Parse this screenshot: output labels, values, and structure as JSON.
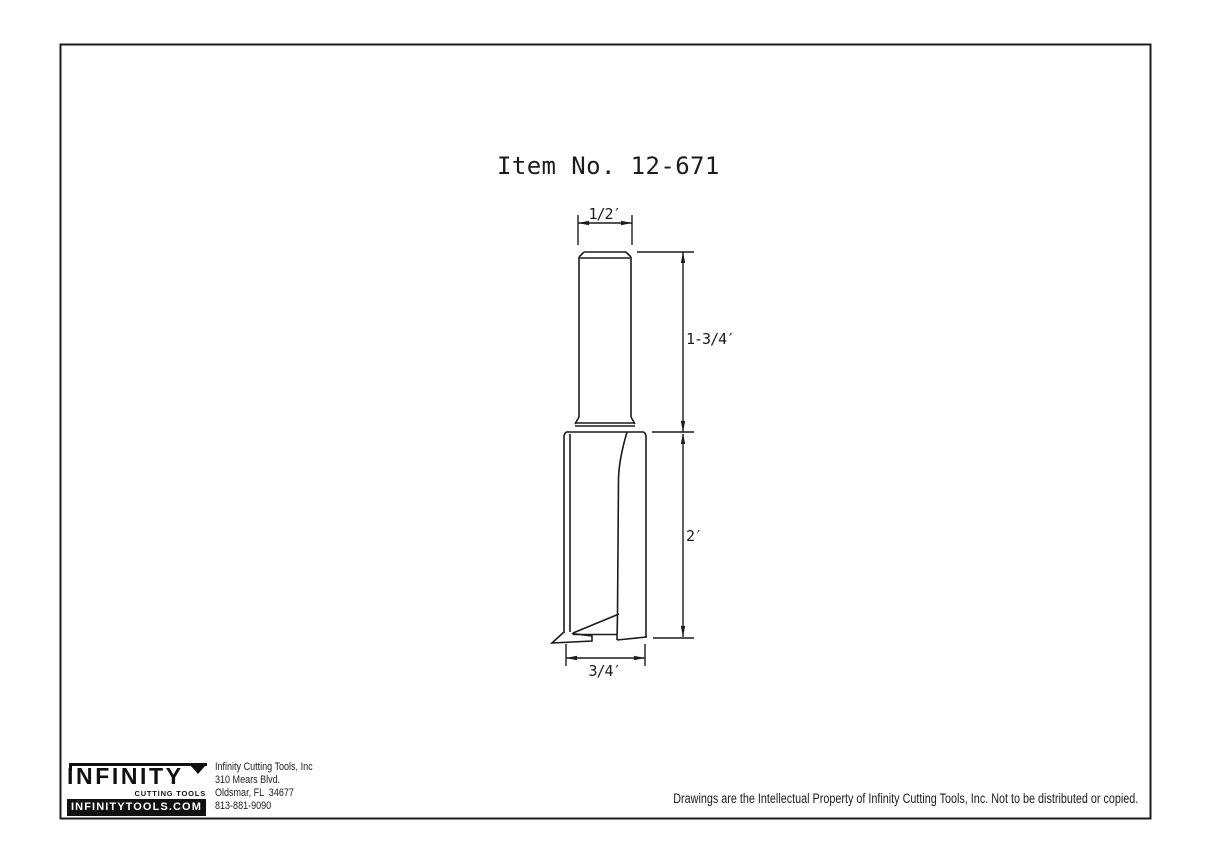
{
  "drawing": {
    "item_label": "Item No. 12-671",
    "dimensions": {
      "shank_diameter": "1/2′",
      "shank_length": "1-3/4′",
      "cutting_length": "2′",
      "cutting_diameter": "3/4′"
    }
  },
  "footer": {
    "logo": {
      "brand": "INFINITY",
      "tagline": "CUTTING TOOLS",
      "website": "INFINITYTOOLS.COM"
    },
    "address": {
      "company": "Infinity Cutting Tools, Inc",
      "street": "310 Mears Blvd.",
      "city_state_zip": "Oldsmar, FL  34677",
      "phone": "813-881-9090"
    },
    "copyright": "Drawings are the Intellectual Property of Infinity Cutting Tools, Inc. Not to be distributed or copied."
  },
  "colors": {
    "line": "#1c1c1c",
    "background": "#ffffff"
  }
}
